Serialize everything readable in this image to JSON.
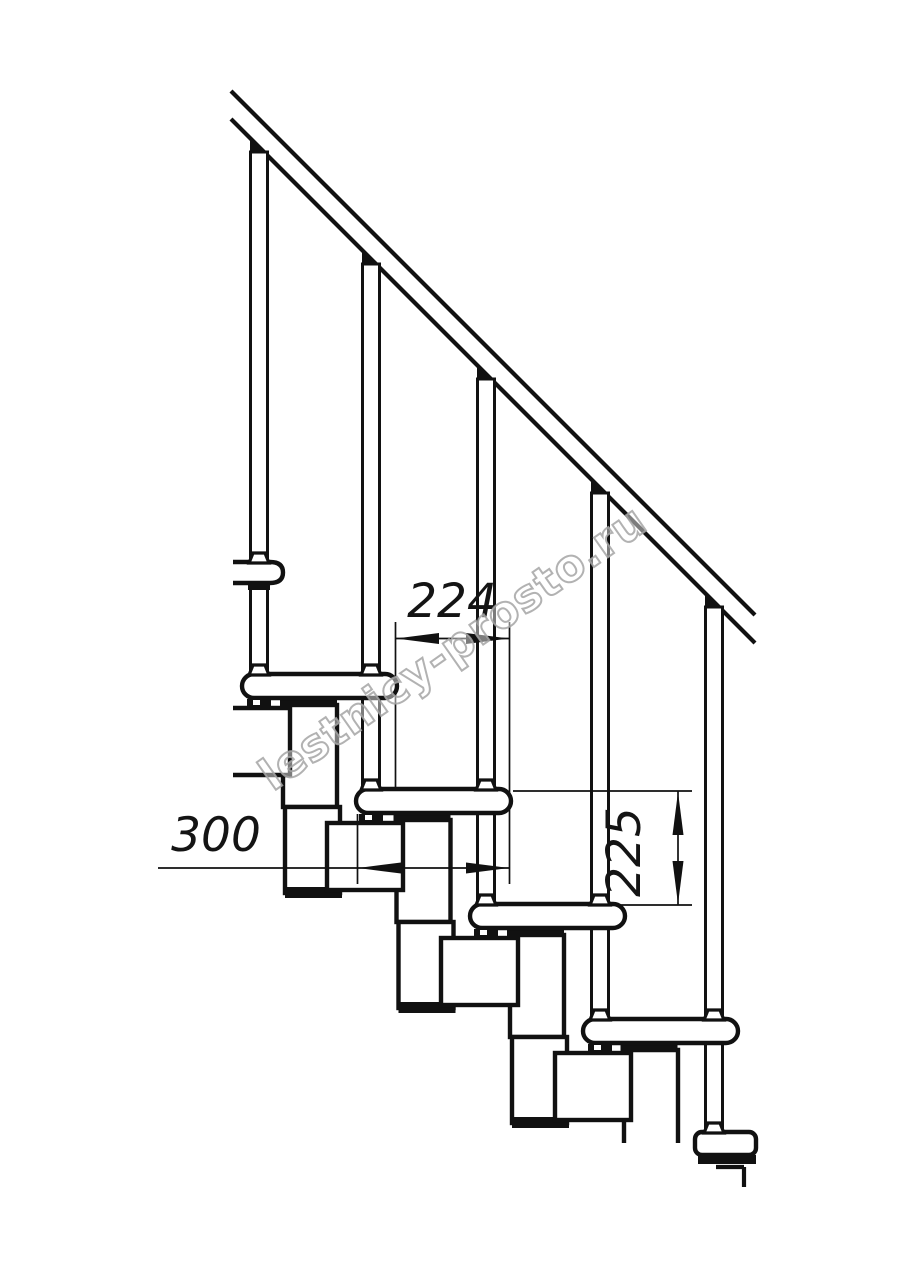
{
  "page": {
    "background_color": "#ffffff"
  },
  "drawing": {
    "kind": "technical line drawing",
    "subject": "modular staircase side-view section with handrail, balusters, treads and support modules",
    "line_color": "#111111",
    "counts": {
      "full_treads": 4,
      "cut_treads": 2,
      "balusters": 5,
      "support_modules": 4
    },
    "dimensions": [
      {
        "id": "going",
        "value": "224",
        "orientation": "horizontal"
      },
      {
        "id": "tread_depth",
        "value": "300",
        "orientation": "horizontal"
      },
      {
        "id": "riser_height",
        "value": "225",
        "orientation": "vertical"
      }
    ]
  },
  "watermark": {
    "text": "lestnicy-prosto.ru",
    "outline_color": "#a8a8a8"
  }
}
